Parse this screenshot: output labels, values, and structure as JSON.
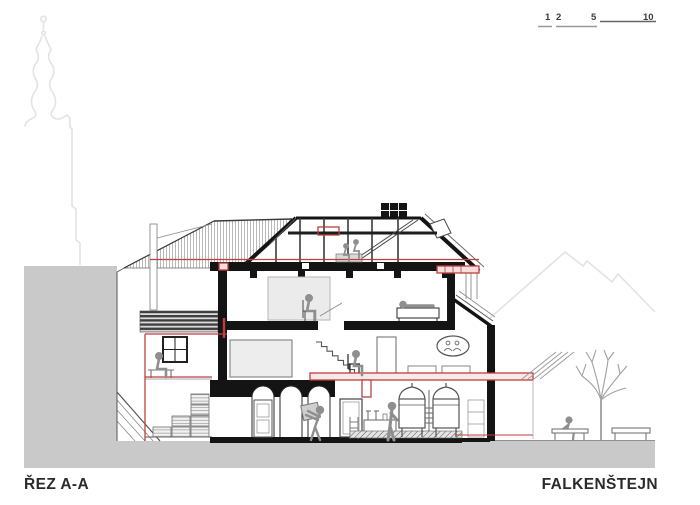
{
  "titles": {
    "section_label": "ŘEZ A-A",
    "project_label": "FALKENŠTEJN"
  },
  "scale_bar": {
    "labels": [
      "1",
      "2",
      "5",
      "10"
    ]
  },
  "colors": {
    "accent_red": "#bd3e3e",
    "terrain_gray": "#c9c9c9",
    "cut_black": "#141414",
    "faint_outline": "#e3e3e3"
  }
}
